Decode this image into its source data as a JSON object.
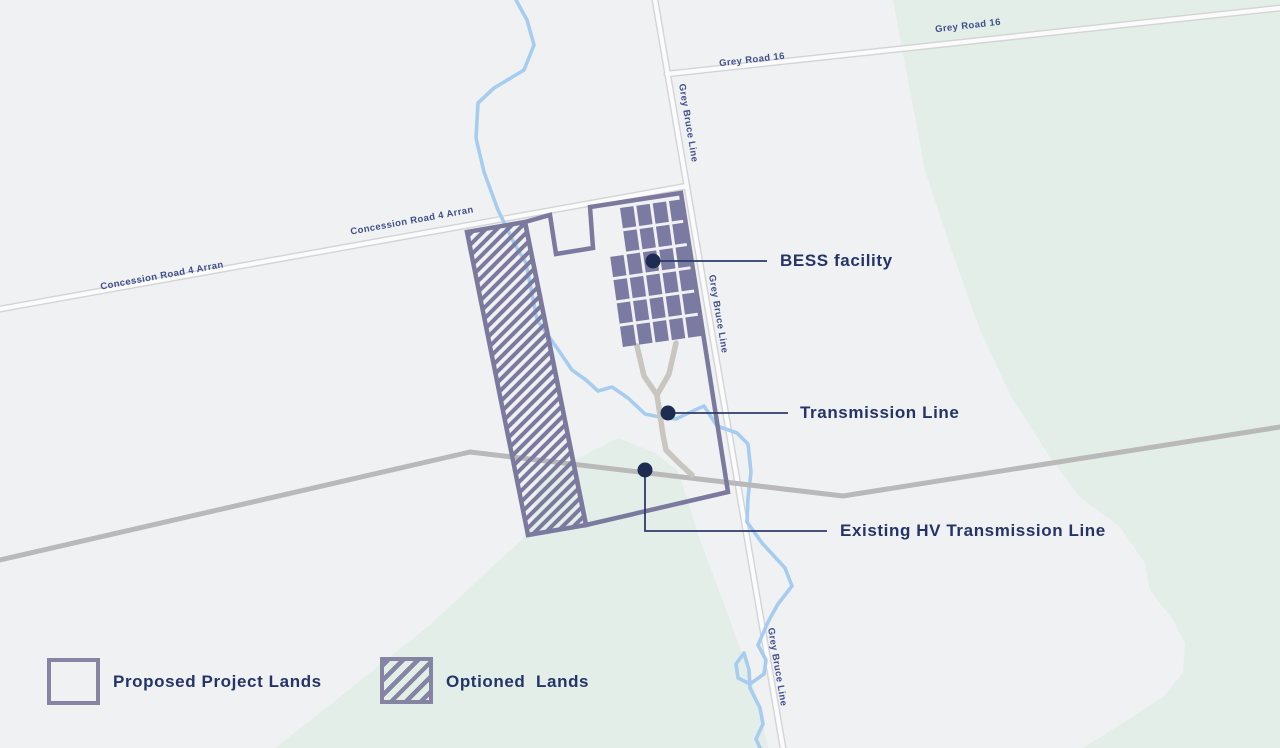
{
  "map": {
    "road_labels": {
      "grey_road_16": "Grey Road 16",
      "grey_bruce_line": "Grey Bruce Line",
      "concession_road": "Concession Road 4 Arran"
    },
    "callouts": {
      "bess": {
        "label": "BESS facility"
      },
      "transmission": {
        "label": "Transmission Line"
      },
      "existing_hv": {
        "label": "Existing HV Transmission Line"
      }
    },
    "facility_grid": {
      "rotation_deg": -8,
      "origin_x": 620,
      "origin_y": 208,
      "panel_w": 13.5,
      "panel_h": 20.5,
      "gap_x": 3,
      "gap_y": 3,
      "rows": [
        {
          "start_col": 0,
          "cols": 4
        },
        {
          "start_col": 0,
          "cols": 4
        },
        {
          "start_col": -1,
          "cols": 5
        },
        {
          "start_col": -1,
          "cols": 5
        },
        {
          "start_col": -1,
          "cols": 5
        },
        {
          "start_col": -1,
          "cols": 5
        }
      ]
    },
    "colors": {
      "background": "#f0f1f2",
      "green_area": "#e2eee7",
      "road_fill": "#fbfbfc",
      "road_casing": "#d3d4d6",
      "river": "#a6cdf0",
      "hv_line": "#b9b9ba",
      "access_road": "#c9c6c0",
      "boundary_purple": "#7b7a9e",
      "panel_fill": "#7b7aa2",
      "callout_navy": "#1e2c52",
      "label_navy": "#243469",
      "road_label_navy": "#414f8d"
    }
  },
  "legend": {
    "proposed": {
      "label": "Proposed Project Lands"
    },
    "optioned": {
      "label": "Optioned  Lands"
    }
  }
}
